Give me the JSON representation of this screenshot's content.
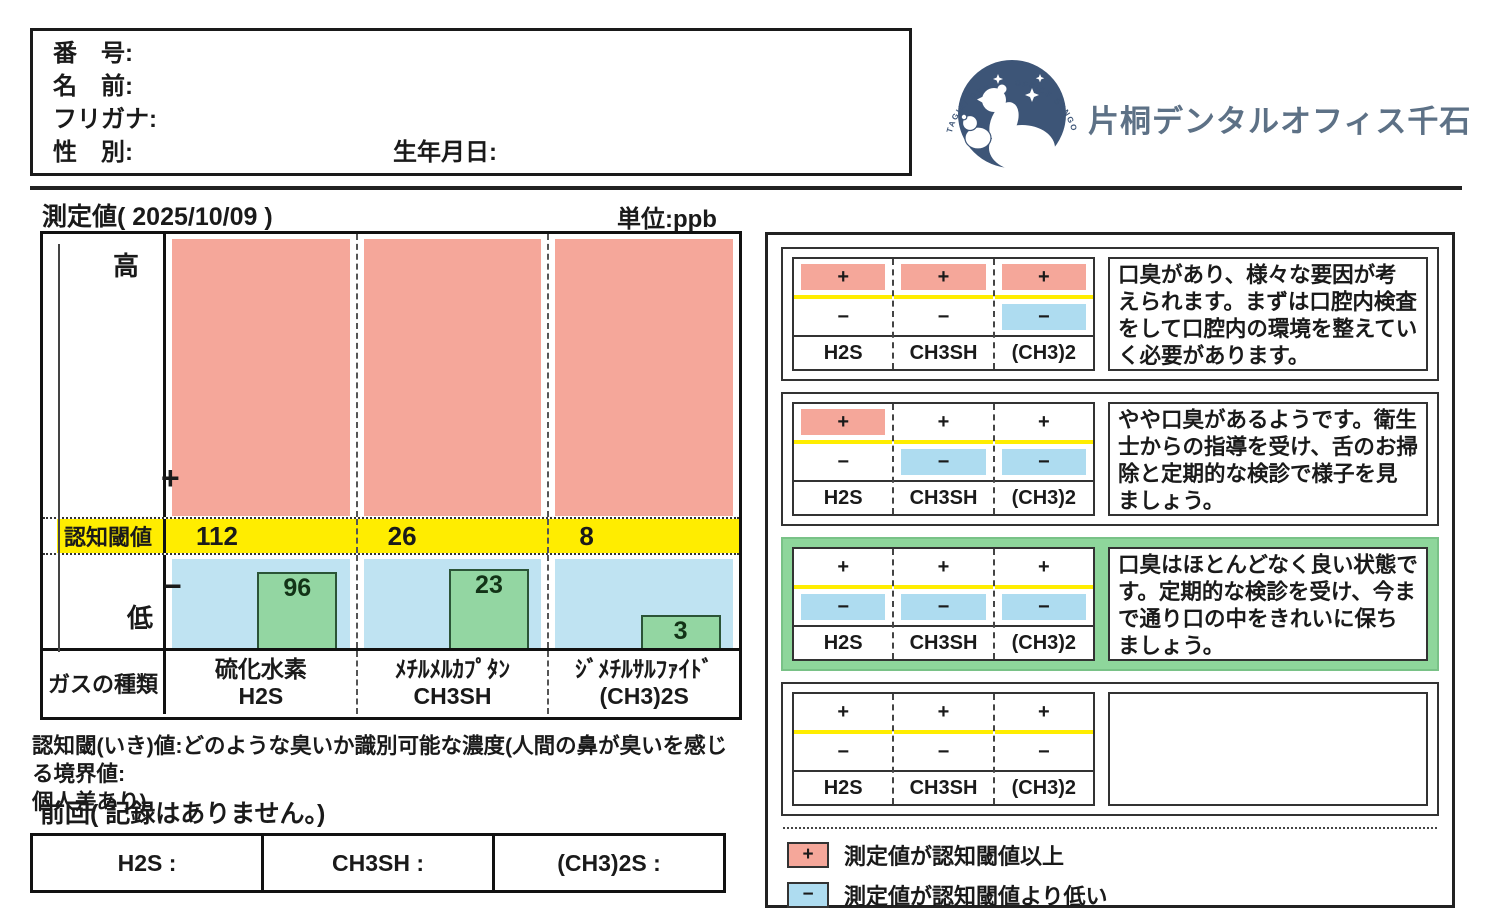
{
  "patient_box": {
    "number_label": "番　号:",
    "name_label": "名　前:",
    "furigana_label": "フリガナ:",
    "gender_label": "性　別:",
    "birthdate_label": "生年月日:"
  },
  "clinic": {
    "name": "片桐デンタルオフィス千石",
    "logo_arc_text": "KATAGIRI DENTAL OFFICE SENGOKU"
  },
  "measurement": {
    "title": "測定値( 2025/10/09 )",
    "unit_label": "単位:ppb"
  },
  "chart": {
    "axis": {
      "high": "高",
      "plus": "+",
      "threshold_label": "認知閾値",
      "minus": "−",
      "low": "低",
      "gas_type_label": "ガスの種類"
    },
    "columns": [
      {
        "gas_name": "硫化水素",
        "formula": "H2S",
        "threshold": 112,
        "value": 96
      },
      {
        "gas_name": "ﾒﾁﾙﾒﾙｶﾌﾟﾀﾝ",
        "formula": "CH3SH",
        "threshold": 26,
        "value": 23
      },
      {
        "gas_name": "ｼﾞﾒﾁﾙｻﾙﾌｧｲﾄﾞ",
        "formula": "(CH3)2S",
        "threshold": 8,
        "value": 3
      }
    ],
    "colors": {
      "above_threshold": "#f5a79a",
      "threshold_band": "#ffed00",
      "below_threshold": "#bfe3f2",
      "bar": "#93d6a2",
      "highlight": "#8ed69b",
      "legend_blue": "#aedcf0"
    }
  },
  "chart_data": {
    "type": "bar",
    "title": "測定値( 2025/10/09 )",
    "unit": "ppb",
    "categories": [
      "硫化水素 H2S",
      "ﾒﾁﾙﾒﾙｶﾌﾟﾀﾝ CH3SH",
      "ｼﾞﾒﾁﾙｻﾙﾌｧｲﾄﾞ (CH3)2S"
    ],
    "series": [
      {
        "name": "測定値",
        "values": [
          96,
          23,
          3
        ]
      },
      {
        "name": "認知閾値",
        "values": [
          112,
          26,
          8
        ]
      }
    ],
    "ylabel": "濃度 (ppb)",
    "annotations": [
      "全ガス測定値が認知閾値より低い"
    ],
    "legend_position": "bottom-right"
  },
  "footnote": {
    "lines": [
      "認知閾(いき)値:どのような臭いか識別可能な濃度(人間の鼻が臭いを感じる境界値:",
      "個人差あり)"
    ]
  },
  "previous": {
    "label": "前回( 記録はありません。)",
    "cells": [
      "H2S :",
      "CH3SH :",
      "(CH3)2S :"
    ]
  },
  "interpretation_panel": {
    "symbols": {
      "plus": "+",
      "minus": "−"
    },
    "gas_labels": [
      "H2S",
      "CH3SH",
      "(CH3)2"
    ],
    "boxes": [
      {
        "pattern": {
          "plus": [
            true,
            true,
            true
          ],
          "minus": [
            false,
            false,
            true
          ]
        },
        "highlighted": false,
        "text": "口臭があり、様々な要因が考えられます。まずは口腔内検査をして口腔内の環境を整えていく必要があります。"
      },
      {
        "pattern": {
          "plus": [
            true,
            false,
            false
          ],
          "minus": [
            false,
            true,
            true
          ]
        },
        "highlighted": false,
        "text": "やや口臭があるようです。衛生士からの指導を受け、舌のお掃除と定期的な検診で様子を見ましょう。"
      },
      {
        "pattern": {
          "plus": [
            false,
            false,
            false
          ],
          "minus": [
            true,
            true,
            true
          ]
        },
        "highlighted": true,
        "text": "口臭はほとんどなく良い状態です。定期的な検診を受け、今まで通り口の中をきれいに保ちましょう。"
      },
      {
        "pattern": {
          "plus": [
            false,
            false,
            false
          ],
          "minus": [
            false,
            false,
            false
          ]
        },
        "highlighted": false,
        "text": ""
      }
    ],
    "legend": [
      {
        "symbol": "+",
        "fill": "pink",
        "text": "測定値が認知閾値以上"
      },
      {
        "symbol": "−",
        "fill": "blue",
        "text": "測定値が認知閾値より低い"
      }
    ]
  }
}
